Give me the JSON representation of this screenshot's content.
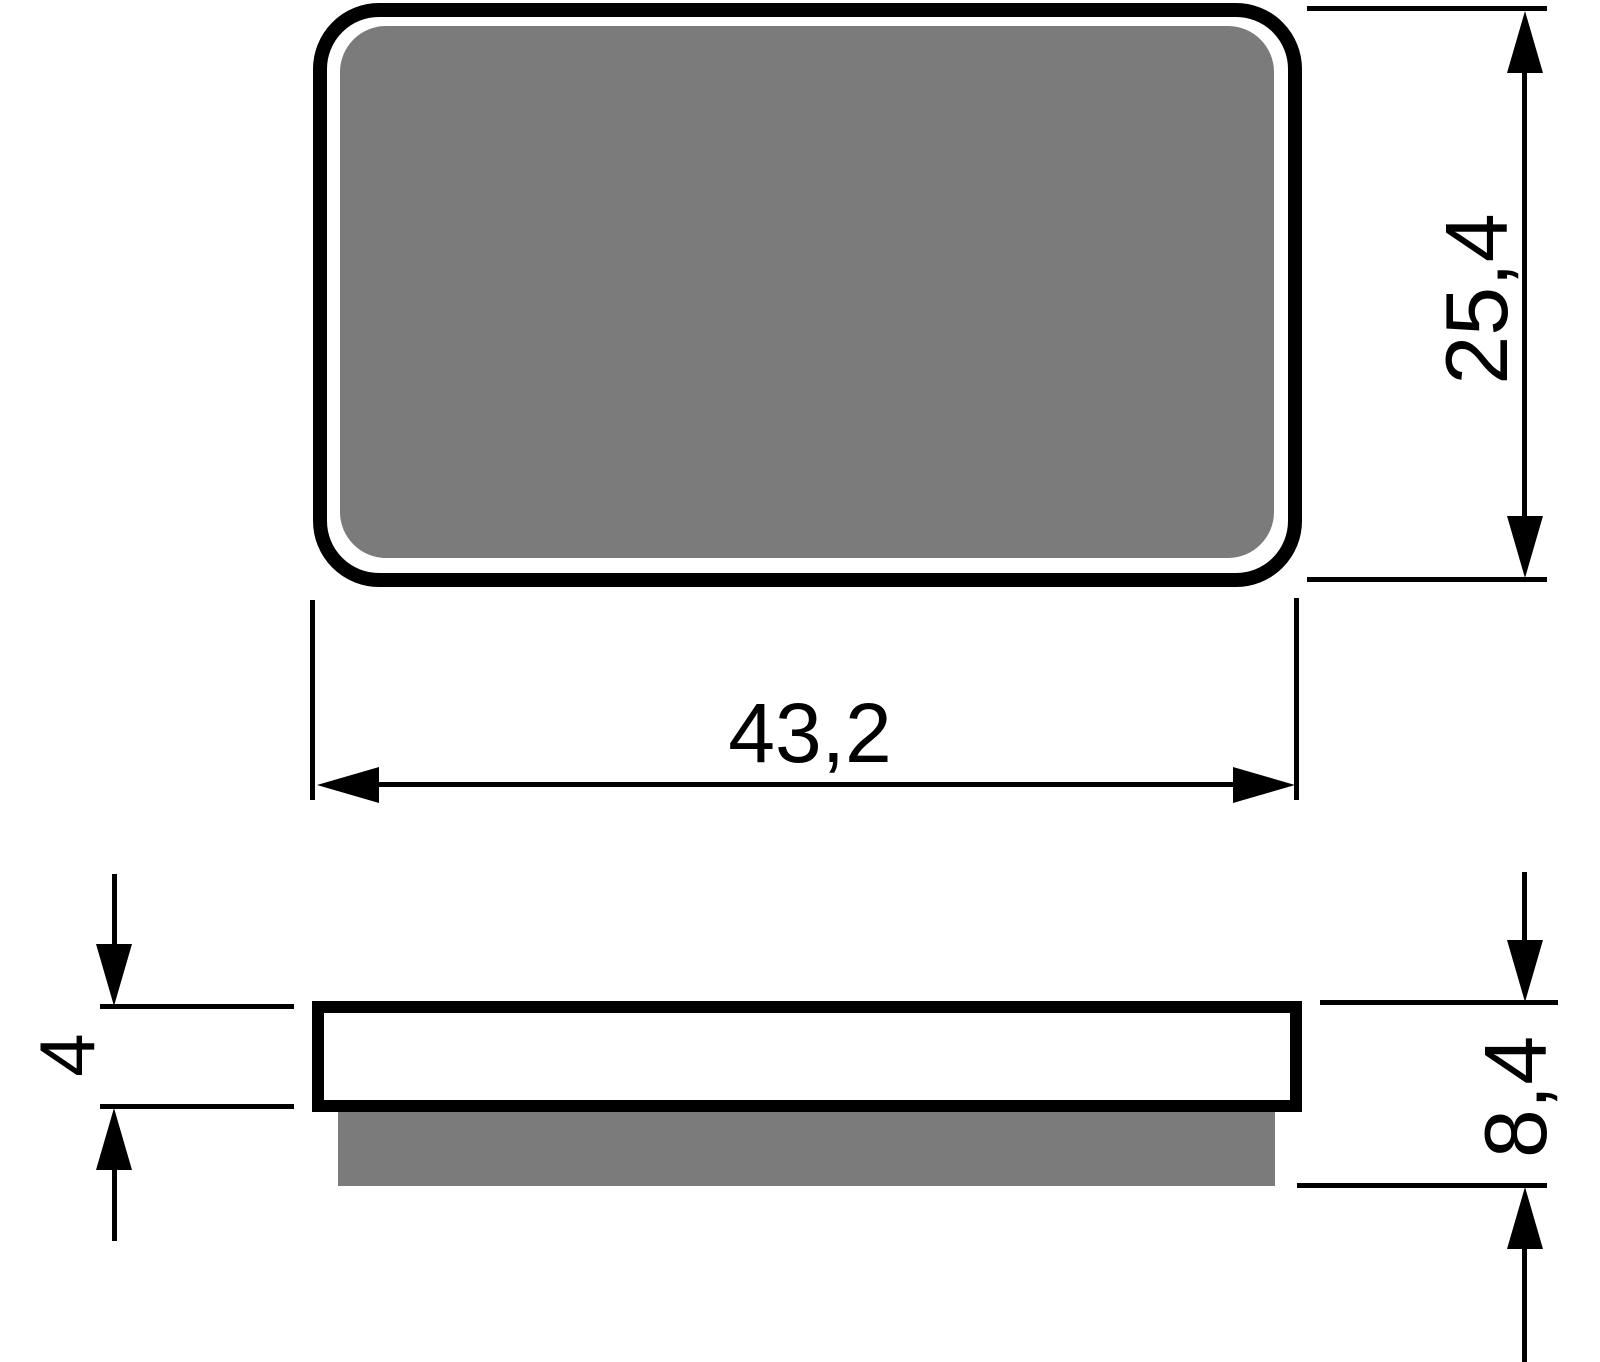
{
  "dimensions": {
    "width": "43,2",
    "height": "25,4",
    "backplate_thickness": "4",
    "total_thickness": "8,4"
  },
  "colors": {
    "ink": "#000000",
    "friction-gray": "#7b7b7b",
    "plate-white": "#ffffff",
    "background": "#ffffff"
  }
}
